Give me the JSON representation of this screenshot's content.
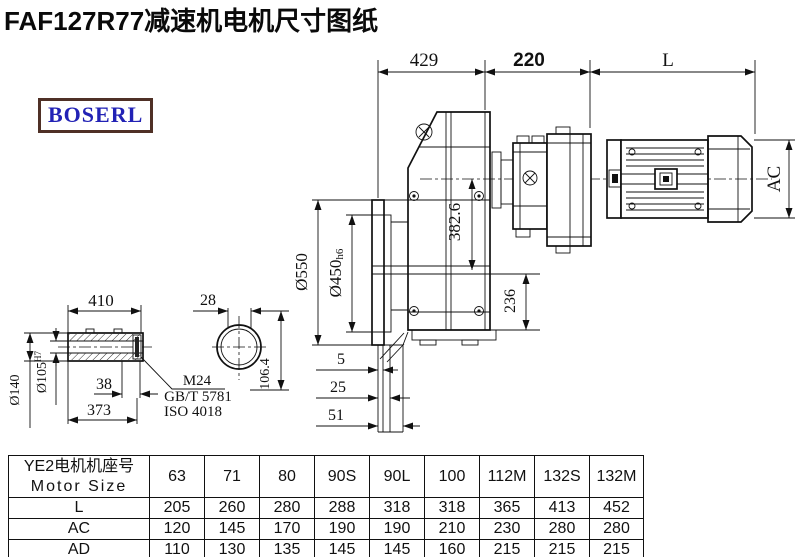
{
  "title": "FAF127R77减速机电机尺寸图纸",
  "logo": {
    "text": "BOSERL",
    "text_color": "#2222b5",
    "border_color": "#4f3026"
  },
  "drawing": {
    "dims": {
      "top_429": "429",
      "top_220": "220",
      "top_l": "L",
      "ac": "AC",
      "dia550": "Ø550",
      "dia450": "Ø450",
      "dia450_suffix": "h6",
      "height_382_6": "382.6",
      "height_236": "236",
      "len_410": "410",
      "flat_28": "28",
      "len_38": "38",
      "len_373": "373",
      "off_5": "5",
      "off_25": "25",
      "off_51": "51",
      "height_106_4": "106.4",
      "dia140": "Ø140",
      "dia105": "Ø105",
      "dia105_suffix": "H7",
      "thread": "M24",
      "std_gb": "GB/T 5781",
      "std_iso": "ISO 4018"
    }
  },
  "table": {
    "header_line1": "YE2电机机座号",
    "header_line2": "Motor Size",
    "sizes": [
      "63",
      "71",
      "80",
      "90S",
      "90L",
      "100",
      "112M",
      "132S",
      "132M"
    ],
    "rows": [
      {
        "label": "L",
        "values": [
          "205",
          "260",
          "280",
          "288",
          "318",
          "318",
          "365",
          "413",
          "452"
        ]
      },
      {
        "label": "AC",
        "values": [
          "120",
          "145",
          "170",
          "190",
          "190",
          "210",
          "230",
          "280",
          "280"
        ]
      },
      {
        "label": "AD",
        "values": [
          "110",
          "130",
          "135",
          "145",
          "145",
          "160",
          "215",
          "215",
          "215"
        ]
      }
    ]
  }
}
